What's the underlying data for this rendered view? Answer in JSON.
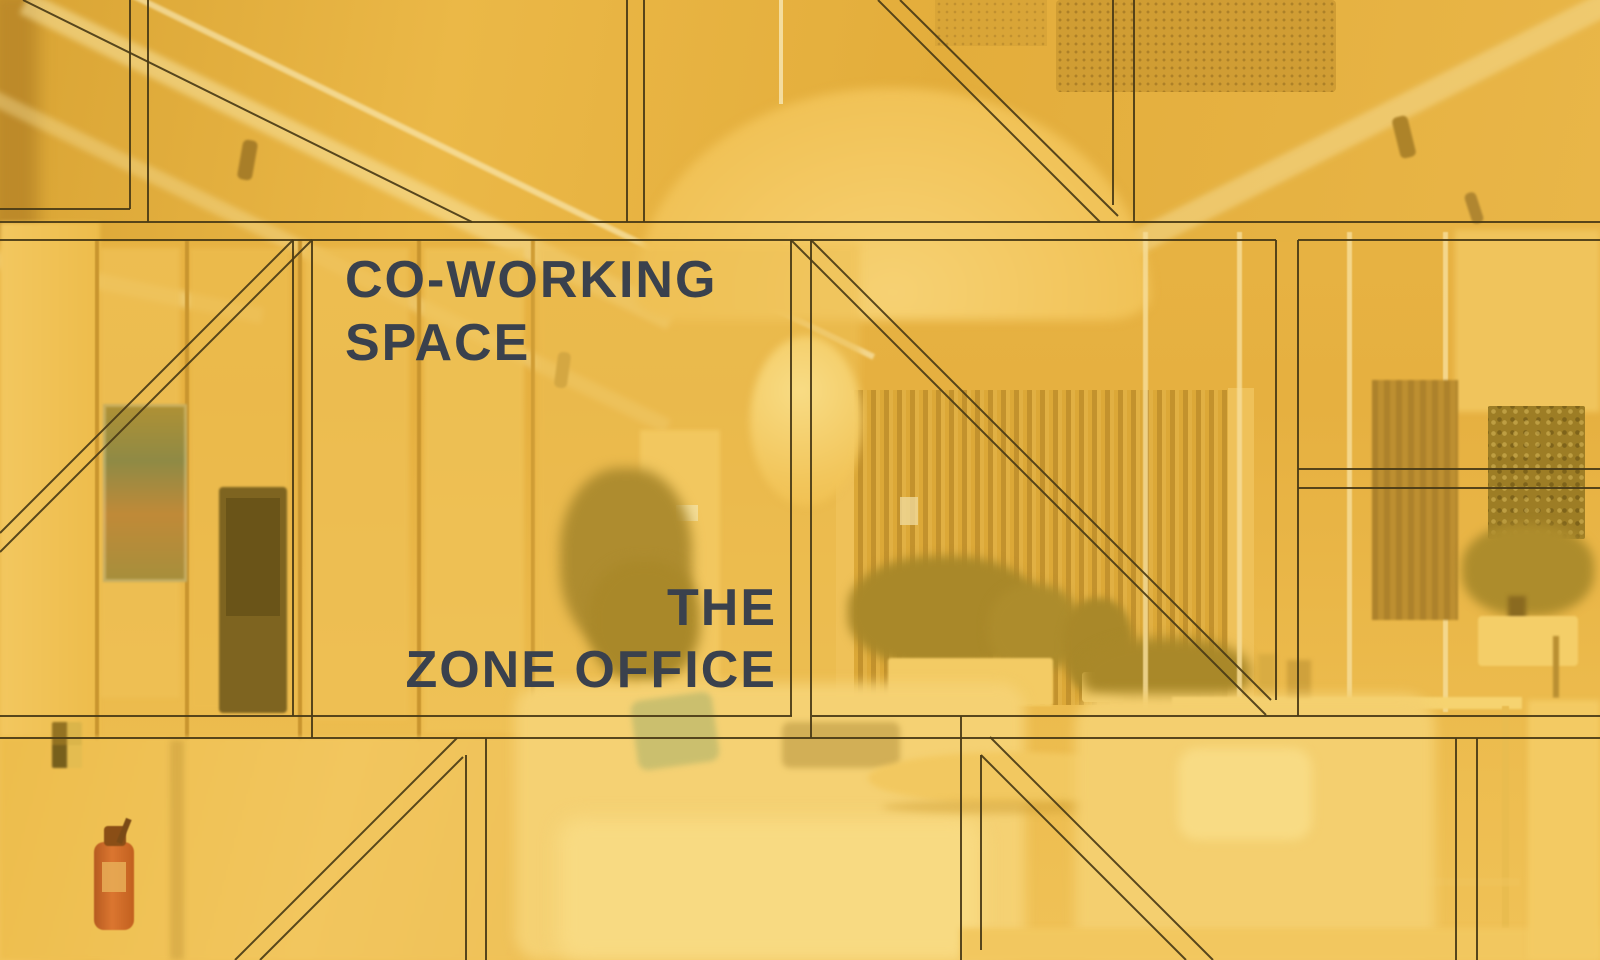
{
  "poster": {
    "heading_line1": "CO-WORKING",
    "heading_line2": "SPACE",
    "subheading_line1": "THE",
    "subheading_line2": "ZONE OFFICE"
  },
  "colors": {
    "overlay_amber": "#E7B13C",
    "blueprint_line": "#4A3B16",
    "title_ink": "#3A414D"
  }
}
